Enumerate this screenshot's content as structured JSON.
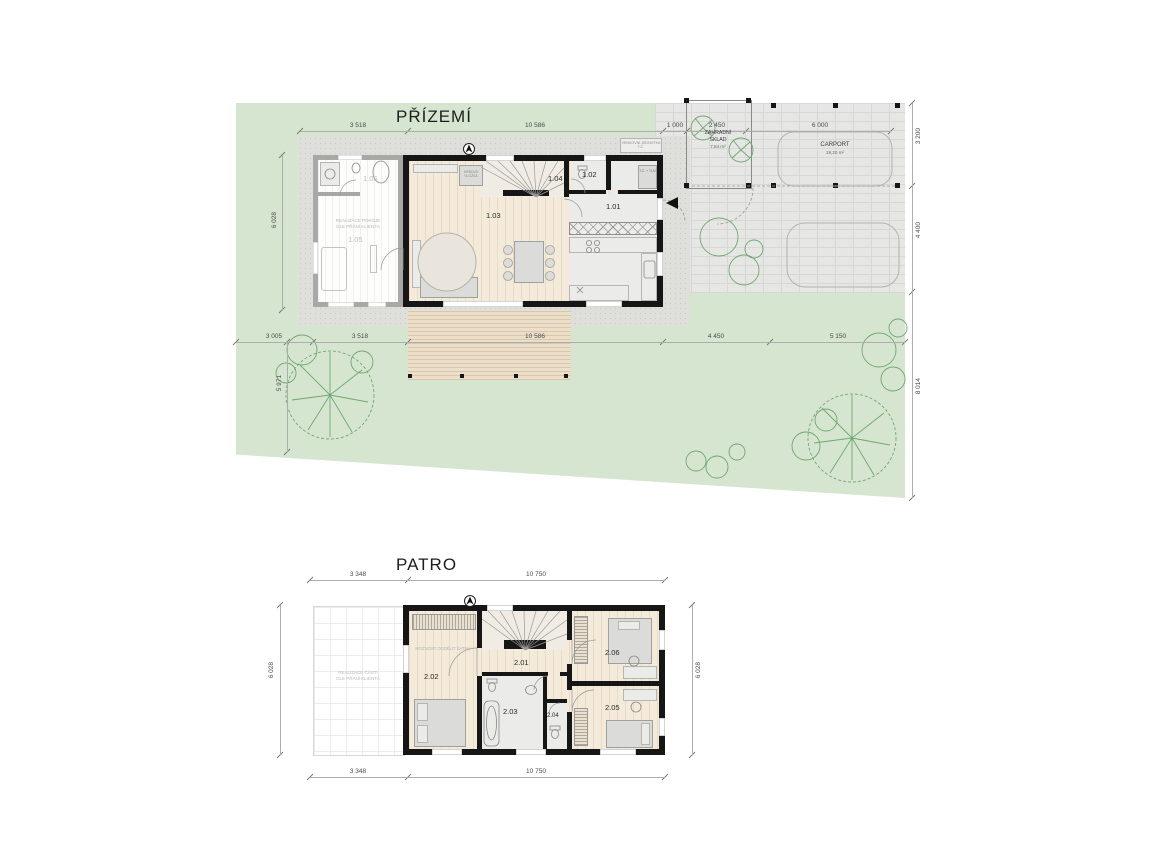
{
  "colors": {
    "site_green": "#d6e5d0",
    "paving_gray": "#e6e6e4",
    "wall_black": "#161616",
    "ghost_wall_gray": "#a7a7a5",
    "wood_floor": "#f4ead9",
    "tree_green": "#6fa86f"
  },
  "ground_floor": {
    "title": "PŘÍZEMÍ",
    "room_labels": {
      "r101": "1.01",
      "r102": "1.02",
      "r103": "1.03",
      "r104": "1.04",
      "r105": "1.05",
      "r106": "1.06"
    },
    "annex_note_line1": "REALIZACE POKOJE",
    "annex_note_line2": "DLE PŘÁNÍ KLIENTA",
    "fireplace_label": "KRBOVÁ VLOŽKA",
    "tech_unit_label": "T.Č. + TUV",
    "outdoor_unit_label": "VENKOVNÍ JEDNOTKA T.Č.",
    "shed_name_line1": "ZAHRADNÍ",
    "shed_name_line2": "SKLAD",
    "shed_area": "7,84 m²",
    "carport_name": "CARPORT",
    "carport_area": "19,20 m²",
    "dims_top": [
      "3 518",
      "10 586",
      "1 000",
      "2 450",
      "6 000"
    ],
    "dims_bottom": [
      "3 005",
      "3 518",
      "10 586",
      "4 450",
      "5 150"
    ],
    "dims_left": [
      "6 028",
      "5 971"
    ],
    "dims_right": [
      "3 200",
      "4 400",
      "8 014"
    ]
  },
  "upper_floor": {
    "title": "PATRO",
    "room_labels": {
      "r201": "2.01",
      "r202": "2.02",
      "r203": "2.03",
      "r204": "2.04",
      "r205": "2.05",
      "r206": "2.06"
    },
    "annex_note_line1": "REALIZACE ČÁSTI",
    "annex_note_line2": "DLE PŘÁNÍ KLIENTA",
    "wardrobe_note": "MOŽNOST ODDĚLIT ŠATNU",
    "dims_top": [
      "3 348",
      "10 750"
    ],
    "dims_bottom": [
      "3 348",
      "10 750"
    ],
    "dims_left": [
      "6 028"
    ],
    "dims_right": [
      "6 028"
    ]
  }
}
